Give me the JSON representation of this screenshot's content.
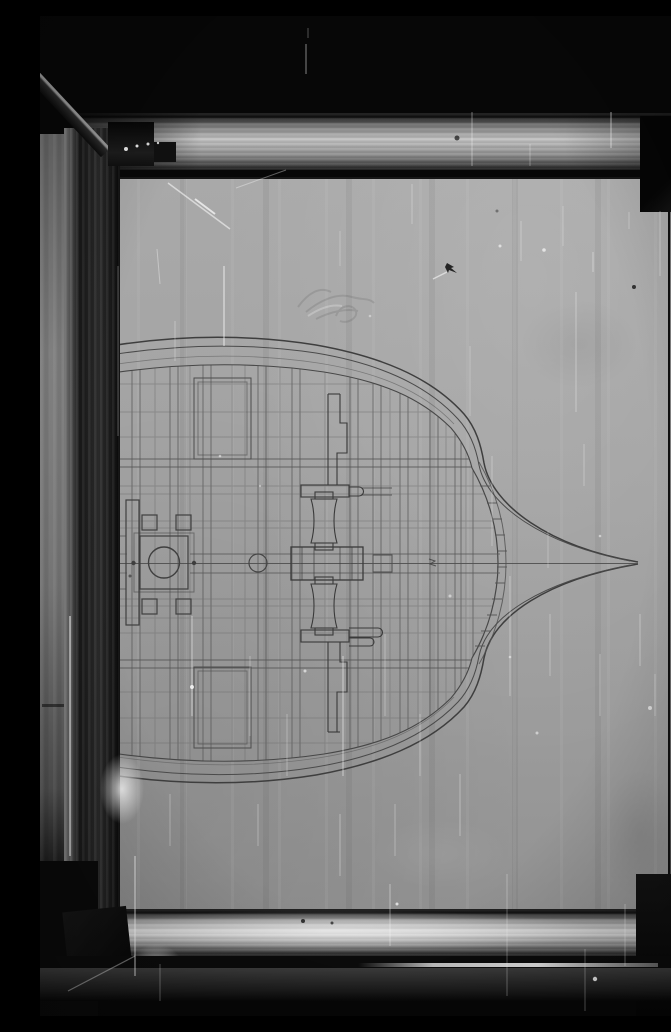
{
  "scene": {
    "description": "Black-and-white photograph of a framed naval-architecture drawing: the deck plan of a ship hull with bow pointing right, drawn in fine pencil lines on grey paper inside a polished metal frame, clamped on a stand against a black background; film surface covered with scratches and dust.",
    "subject": "ship-deck-plan-drawing",
    "frame_material": "polished-metal",
    "bow_direction": "right"
  },
  "palette": {
    "background": "#070707",
    "paper": "#a1a1a1",
    "ink_line": "#4a4a4a",
    "hull_line": "#3e3e3e",
    "frame_bright": "#d9d9d9",
    "frame_shadow": "#1b1b1b",
    "scratch_white": "#ffffff"
  },
  "defects": {
    "scratches": [
      {
        "x1": 266,
        "y1": 28,
        "x2": 266,
        "y2": 58,
        "w": 1,
        "o": 0.5
      },
      {
        "x1": 268,
        "y1": 12,
        "x2": 268,
        "y2": 22,
        "w": 1,
        "o": 0.3
      },
      {
        "x1": 432,
        "y1": 96,
        "x2": 432,
        "y2": 150,
        "w": 1,
        "o": 0.4
      },
      {
        "x1": 571,
        "y1": 96,
        "x2": 571,
        "y2": 132,
        "w": 1.2,
        "o": 0.5
      },
      {
        "x1": 490,
        "y1": 128,
        "x2": 490,
        "y2": 150,
        "w": 1,
        "o": 0.3
      },
      {
        "x1": 128,
        "y1": 167,
        "x2": 190,
        "y2": 213,
        "w": 1.5,
        "o": 0.55
      },
      {
        "x1": 155,
        "y1": 183,
        "x2": 175,
        "y2": 198,
        "w": 2,
        "o": 0.7
      },
      {
        "x1": 196,
        "y1": 172,
        "x2": 246,
        "y2": 154,
        "w": 1,
        "o": 0.35
      },
      {
        "x1": 117,
        "y1": 233,
        "x2": 120,
        "y2": 268,
        "w": 1,
        "o": 0.35
      },
      {
        "x1": 184,
        "y1": 250,
        "x2": 184,
        "y2": 330,
        "w": 1.5,
        "o": 0.5
      },
      {
        "x1": 135,
        "y1": 305,
        "x2": 135,
        "y2": 345,
        "w": 1,
        "o": 0.3
      },
      {
        "x1": 372,
        "y1": 168,
        "x2": 372,
        "y2": 208,
        "w": 1,
        "o": 0.3
      },
      {
        "x1": 300,
        "y1": 215,
        "x2": 300,
        "y2": 250,
        "w": 1,
        "o": 0.25
      },
      {
        "x1": 481,
        "y1": 205,
        "x2": 481,
        "y2": 245,
        "w": 1,
        "o": 0.3
      },
      {
        "x1": 523,
        "y1": 190,
        "x2": 523,
        "y2": 230,
        "w": 1,
        "o": 0.25
      },
      {
        "x1": 536,
        "y1": 276,
        "x2": 536,
        "y2": 396,
        "w": 1,
        "o": 0.35
      },
      {
        "x1": 553,
        "y1": 236,
        "x2": 553,
        "y2": 256,
        "w": 1,
        "o": 0.4
      },
      {
        "x1": 589,
        "y1": 196,
        "x2": 589,
        "y2": 213,
        "w": 1,
        "o": 0.3
      },
      {
        "x1": 620,
        "y1": 195,
        "x2": 620,
        "y2": 260,
        "w": 1,
        "o": 0.35
      },
      {
        "x1": 640,
        "y1": 270,
        "x2": 640,
        "y2": 420,
        "w": 1,
        "o": 0.3
      },
      {
        "x1": 648,
        "y1": 455,
        "x2": 648,
        "y2": 560,
        "w": 1,
        "o": 0.25
      },
      {
        "x1": 430,
        "y1": 330,
        "x2": 430,
        "y2": 400,
        "w": 1,
        "o": 0.25
      },
      {
        "x1": 452,
        "y1": 440,
        "x2": 452,
        "y2": 530,
        "w": 1,
        "o": 0.3
      },
      {
        "x1": 508,
        "y1": 515,
        "x2": 508,
        "y2": 552,
        "w": 1,
        "o": 0.25
      },
      {
        "x1": 544,
        "y1": 428,
        "x2": 544,
        "y2": 470,
        "w": 1,
        "o": 0.3
      },
      {
        "x1": 470,
        "y1": 560,
        "x2": 470,
        "y2": 680,
        "w": 1,
        "o": 0.35
      },
      {
        "x1": 510,
        "y1": 598,
        "x2": 510,
        "y2": 660,
        "w": 1,
        "o": 0.3
      },
      {
        "x1": 560,
        "y1": 638,
        "x2": 560,
        "y2": 700,
        "w": 1,
        "o": 0.3
      },
      {
        "x1": 600,
        "y1": 598,
        "x2": 600,
        "y2": 650,
        "w": 1,
        "o": 0.35
      },
      {
        "x1": 615,
        "y1": 658,
        "x2": 615,
        "y2": 700,
        "w": 1,
        "o": 0.3
      },
      {
        "x1": 152,
        "y1": 600,
        "x2": 152,
        "y2": 700,
        "w": 1.2,
        "o": 0.4
      },
      {
        "x1": 210,
        "y1": 640,
        "x2": 210,
        "y2": 720,
        "w": 1,
        "o": 0.3
      },
      {
        "x1": 247,
        "y1": 698,
        "x2": 247,
        "y2": 760,
        "w": 1,
        "o": 0.3
      },
      {
        "x1": 303,
        "y1": 640,
        "x2": 303,
        "y2": 760,
        "w": 1.2,
        "o": 0.45
      },
      {
        "x1": 345,
        "y1": 618,
        "x2": 345,
        "y2": 700,
        "w": 1,
        "o": 0.3
      },
      {
        "x1": 380,
        "y1": 698,
        "x2": 380,
        "y2": 760,
        "w": 1,
        "o": 0.3
      },
      {
        "x1": 420,
        "y1": 758,
        "x2": 420,
        "y2": 820,
        "w": 1,
        "o": 0.35
      },
      {
        "x1": 355,
        "y1": 788,
        "x2": 355,
        "y2": 840,
        "w": 1,
        "o": 0.3
      },
      {
        "x1": 300,
        "y1": 798,
        "x2": 300,
        "y2": 860,
        "w": 1,
        "o": 0.35
      },
      {
        "x1": 218,
        "y1": 788,
        "x2": 218,
        "y2": 830,
        "w": 1,
        "o": 0.3
      },
      {
        "x1": 130,
        "y1": 778,
        "x2": 130,
        "y2": 830,
        "w": 1,
        "o": 0.3
      },
      {
        "x1": 95,
        "y1": 840,
        "x2": 95,
        "y2": 960,
        "w": 1.5,
        "o": 0.5
      },
      {
        "x1": 350,
        "y1": 868,
        "x2": 350,
        "y2": 930,
        "w": 1,
        "o": 0.4
      },
      {
        "x1": 585,
        "y1": 888,
        "x2": 585,
        "y2": 950,
        "w": 1,
        "o": 0.35
      },
      {
        "x1": 467,
        "y1": 858,
        "x2": 467,
        "y2": 980,
        "w": 1,
        "o": 0.3
      },
      {
        "x1": 545,
        "y1": 933,
        "x2": 545,
        "y2": 995,
        "w": 1,
        "o": 0.3
      },
      {
        "x1": 120,
        "y1": 948,
        "x2": 120,
        "y2": 985,
        "w": 1,
        "o": 0.3
      },
      {
        "x1": 28,
        "y1": 975,
        "x2": 95,
        "y2": 940,
        "w": 1.2,
        "o": 0.4
      },
      {
        "x1": 30,
        "y1": 600,
        "x2": 30,
        "y2": 840,
        "w": 2,
        "o": 0.5
      },
      {
        "x1": 78,
        "y1": 250,
        "x2": 78,
        "y2": 420,
        "w": 1,
        "o": 0.3
      },
      {
        "x1": 393,
        "y1": 263,
        "x2": 407,
        "y2": 256,
        "w": 1.5,
        "o": 0.55
      }
    ],
    "white_specks": [
      {
        "x": 86,
        "y": 133,
        "r": 2,
        "o": 0.9
      },
      {
        "x": 97,
        "y": 130,
        "r": 1.5,
        "o": 0.9
      },
      {
        "x": 108,
        "y": 128,
        "r": 1.5,
        "o": 0.85
      },
      {
        "x": 118,
        "y": 127,
        "r": 1.2,
        "o": 0.8
      },
      {
        "x": 152,
        "y": 671,
        "r": 2,
        "o": 0.8
      },
      {
        "x": 265,
        "y": 655,
        "r": 1.5,
        "o": 0.6
      },
      {
        "x": 470,
        "y": 641,
        "r": 1.3,
        "o": 0.5
      },
      {
        "x": 555,
        "y": 963,
        "r": 2.2,
        "o": 0.85
      },
      {
        "x": 357,
        "y": 888,
        "r": 1.5,
        "o": 0.7
      },
      {
        "x": 460,
        "y": 230,
        "r": 1.5,
        "o": 0.6
      },
      {
        "x": 504,
        "y": 234,
        "r": 1.8,
        "o": 0.65
      },
      {
        "x": 560,
        "y": 520,
        "r": 1.3,
        "o": 0.5
      },
      {
        "x": 610,
        "y": 692,
        "r": 2,
        "o": 0.6
      },
      {
        "x": 645,
        "y": 758,
        "r": 1.5,
        "o": 0.5
      },
      {
        "x": 180,
        "y": 440,
        "r": 1.3,
        "o": 0.5
      },
      {
        "x": 220,
        "y": 470,
        "r": 1.2,
        "o": 0.4
      },
      {
        "x": 330,
        "y": 300,
        "r": 1.3,
        "o": 0.4
      },
      {
        "x": 410,
        "y": 580,
        "r": 1.5,
        "o": 0.5
      },
      {
        "x": 497,
        "y": 717,
        "r": 1.5,
        "o": 0.5
      }
    ],
    "dark_specks": [
      {
        "x": 594,
        "y": 271,
        "r": 2,
        "o": 0.8
      },
      {
        "x": 417,
        "y": 122,
        "r": 2.5,
        "o": 0.7
      },
      {
        "x": 457,
        "y": 195,
        "r": 1.5,
        "o": 0.4
      },
      {
        "x": 263,
        "y": 905,
        "r": 2,
        "o": 0.8
      },
      {
        "x": 292,
        "y": 907,
        "r": 1.5,
        "o": 0.7
      },
      {
        "x": 643,
        "y": 838,
        "r": 2,
        "o": 0.5
      },
      {
        "x": 90,
        "y": 560,
        "r": 1.5,
        "o": 0.5
      }
    ]
  }
}
